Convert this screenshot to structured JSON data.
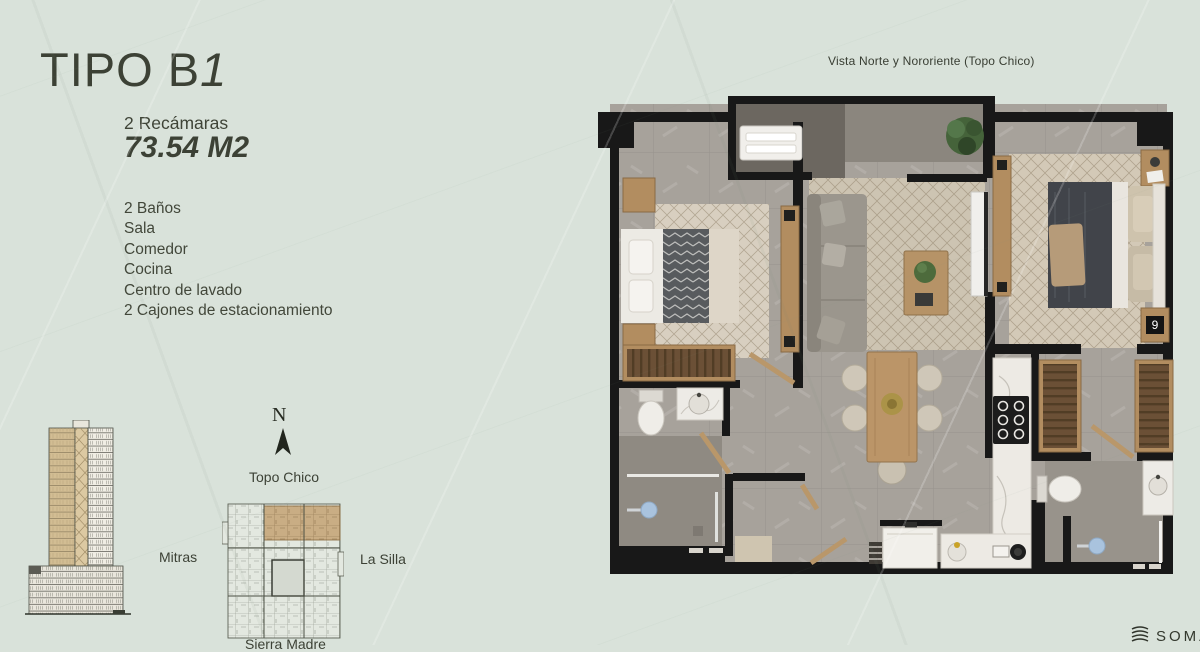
{
  "header": {
    "title_prefix": "TIPO B",
    "title_suffix": "1",
    "bedrooms_label": "2 Recámaras",
    "area_label": "73.54 M2"
  },
  "features": [
    "2 Baños",
    "Sala",
    "Comedor",
    "Cocina",
    "Centro de lavado",
    "2 Cajones de estacionamiento"
  ],
  "floorplan": {
    "view_label": "Vista Norte y Nororiente (Topo Chico)",
    "clock_display": "9"
  },
  "compass": {
    "north": "N",
    "top_label": "Topo Chico",
    "left_label": "Mitras",
    "right_label": "La Silla",
    "bottom_label": "Sierra Madre"
  },
  "logo": {
    "name": "SOMA"
  },
  "colors": {
    "background": "#d9e2da",
    "text": "#3f4437",
    "accent_tan": "#c9ad84",
    "wall_black": "#181818",
    "floor_gray": "#a7a29b",
    "rug_beige": "#cdc4b2",
    "wood": "#b28d60",
    "shower_blue": "#a9c3de"
  }
}
